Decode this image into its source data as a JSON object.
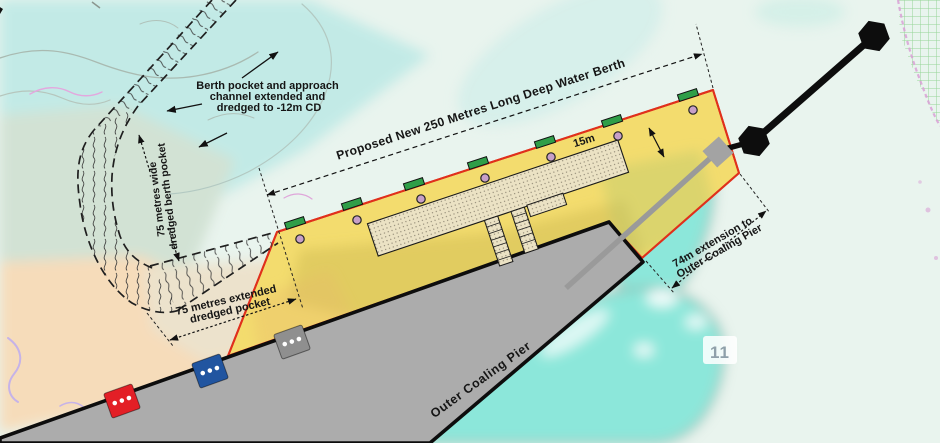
{
  "annotations": {
    "berth_pocket_note": {
      "lines": [
        "Berth pocket and approach",
        "channel extended and",
        "dredged to -12m CD"
      ]
    },
    "pocket_width": {
      "lines": [
        "75 metres wide",
        "dredged berth pocket"
      ]
    },
    "pocket_extension": {
      "lines": [
        "75 metres extended",
        "dredged pocket"
      ]
    },
    "proposed_berth": "Proposed New 250 Metres Long Deep Water Berth",
    "berth_apron_width": "15m",
    "pier_extension": {
      "lines": [
        "74m extension to",
        "Outer Coaling Pier"
      ]
    },
    "pier_name": "Outer Coaling Pier",
    "depth_sounding": "11"
  },
  "colors": {
    "proposed_area": "#f3dc6e",
    "berth_edge": "#e0301c",
    "fender": "#2f9e48",
    "bollard": "#c79fc7",
    "pier": "#acacac",
    "mooring_red": "#e31f26",
    "mooring_blue": "#2155a0",
    "mooring_gray": "#8f8f8f",
    "beacon": "#0d0d0d",
    "water_shallow": "#8ce7da",
    "water_deep": "#c2eae6",
    "land": "#f6dcba"
  }
}
